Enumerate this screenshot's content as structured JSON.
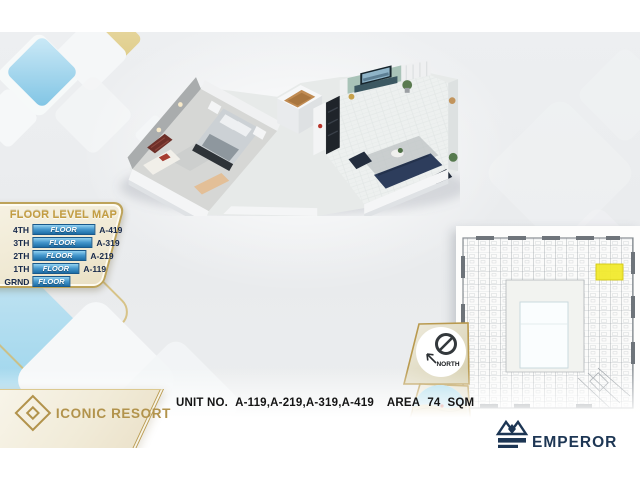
{
  "floor_level_map": {
    "title": "FLOOR LEVEL MAP",
    "rows": [
      {
        "level": "4TH",
        "bar": "FLOOR",
        "unit": "A-419"
      },
      {
        "level": "3TH",
        "bar": "FLOOR",
        "unit": "A-319"
      },
      {
        "level": "2TH",
        "bar": "FLOOR",
        "unit": "A-219"
      },
      {
        "level": "1TH",
        "bar": "FLOOR",
        "unit": "A-119"
      },
      {
        "level": "GRND",
        "bar": "FLOOR",
        "unit": ""
      }
    ]
  },
  "unit_info": {
    "label": "UNIT NO.",
    "units": "A-119,A-219,A-319,A-419",
    "area_label": "AREA",
    "area_value": "74",
    "area_unit": "SQM"
  },
  "compass": {
    "label": "NORTH"
  },
  "location": {
    "lat": "27 18 2.34 N",
    "lng": "33 44 38.36 E"
  },
  "brand": {
    "name": "ICONIC RESORT"
  },
  "developer": {
    "name": "EMPEROR",
    "tagline": "Developments"
  },
  "site_plan": {
    "highlight_color": "#f2ea28"
  },
  "colors": {
    "accent_gold": "#bb9c50",
    "navy": "#17294b",
    "bar_blue": "#2e7fb8",
    "highlight_yellow": "#f2ea28",
    "logo_navy": "#1d3654"
  }
}
